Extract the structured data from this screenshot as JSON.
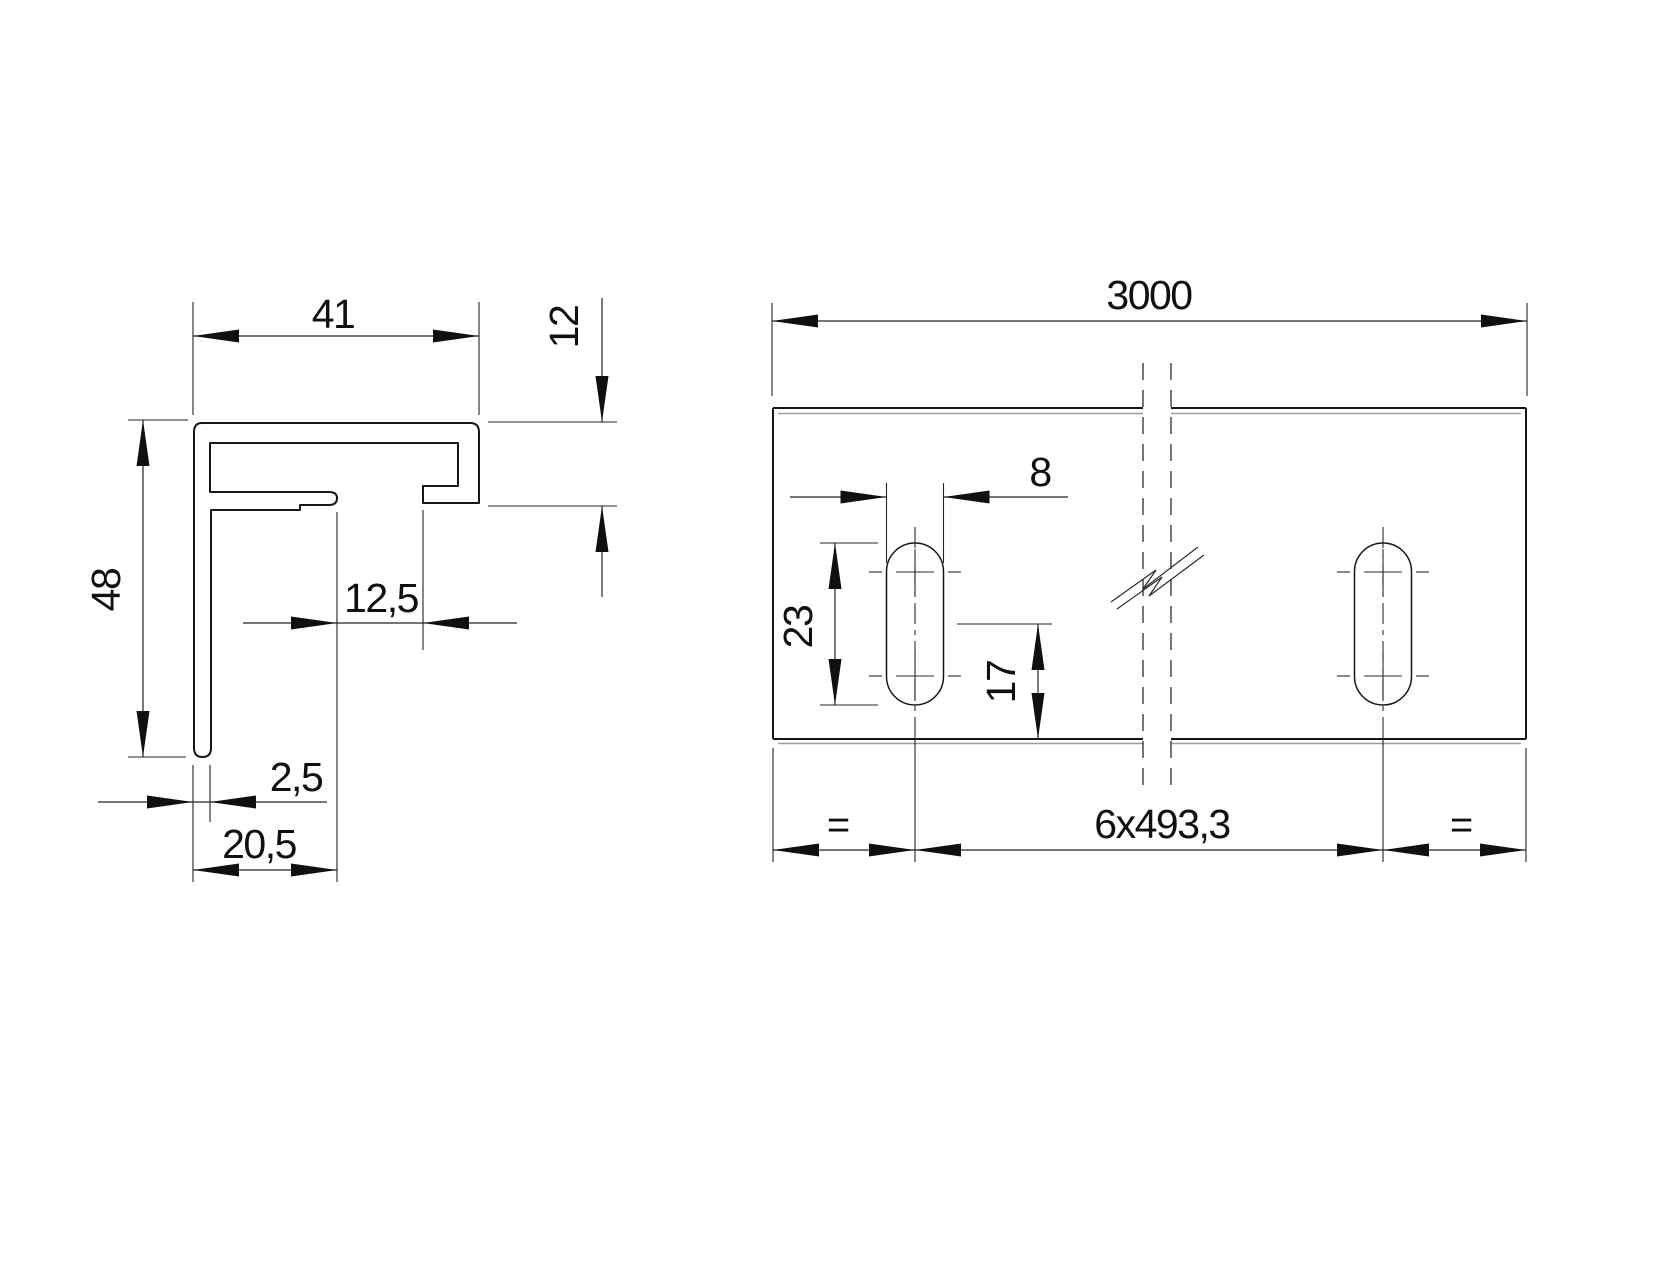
{
  "drawing": {
    "background_color": "#ffffff",
    "main_line_color": "#161616",
    "dim_line_color": "#242424",
    "double_edge_color": "#9b9b9b",
    "profile_view": {
      "dim_top_width": "41",
      "dim_cap_height": "12",
      "dim_total_height": "48",
      "dim_slot_opening": "12,5",
      "dim_wall_thickness": "2,5",
      "dim_base_width": "20,5"
    },
    "rail_view": {
      "dim_length": "3000",
      "dim_slot_width": "8",
      "dim_slot_length": "23",
      "dim_slot_center_from_edge": "17",
      "dim_hole_spacing": "6x493,3",
      "dim_equal_left": "=",
      "dim_equal_right": "="
    }
  }
}
